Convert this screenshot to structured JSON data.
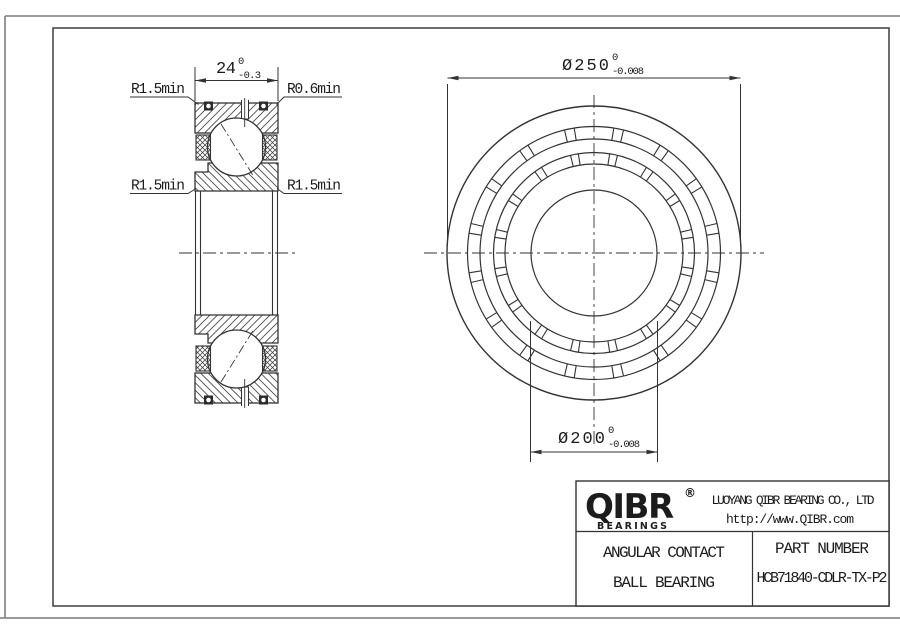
{
  "drawing": {
    "section_view": {
      "dim_width": {
        "nominal": "24",
        "upper": "0",
        "lower": "-0.3"
      },
      "radius_top_left": "R1.5min",
      "radius_top_right": "R0.6min",
      "radius_bottom_left": "R1.5min",
      "radius_bottom_right": "R1.5min"
    },
    "front_view": {
      "dim_outer": {
        "nominal": "Ø250",
        "upper": "0",
        "lower": "-0.008"
      },
      "dim_bore": {
        "nominal": "Ø200",
        "upper": "0",
        "lower": "-0.008"
      }
    }
  },
  "title_block": {
    "logo": {
      "brand": "QIBR",
      "registered": "®",
      "tagline": "BEARINGS"
    },
    "company": "LUOYANG QIBR BEARING CO., LTD",
    "website": "http://www.QIBR.com",
    "product_line1": "ANGULAR CONTACT",
    "product_line2": "BALL BEARING",
    "part_label": "PART NUMBER",
    "part_number": "HCB71840-CDLR-TX-P2"
  },
  "colors": {
    "ink": "#333333",
    "text": "#1c1c1c",
    "background": "#ffffff"
  }
}
